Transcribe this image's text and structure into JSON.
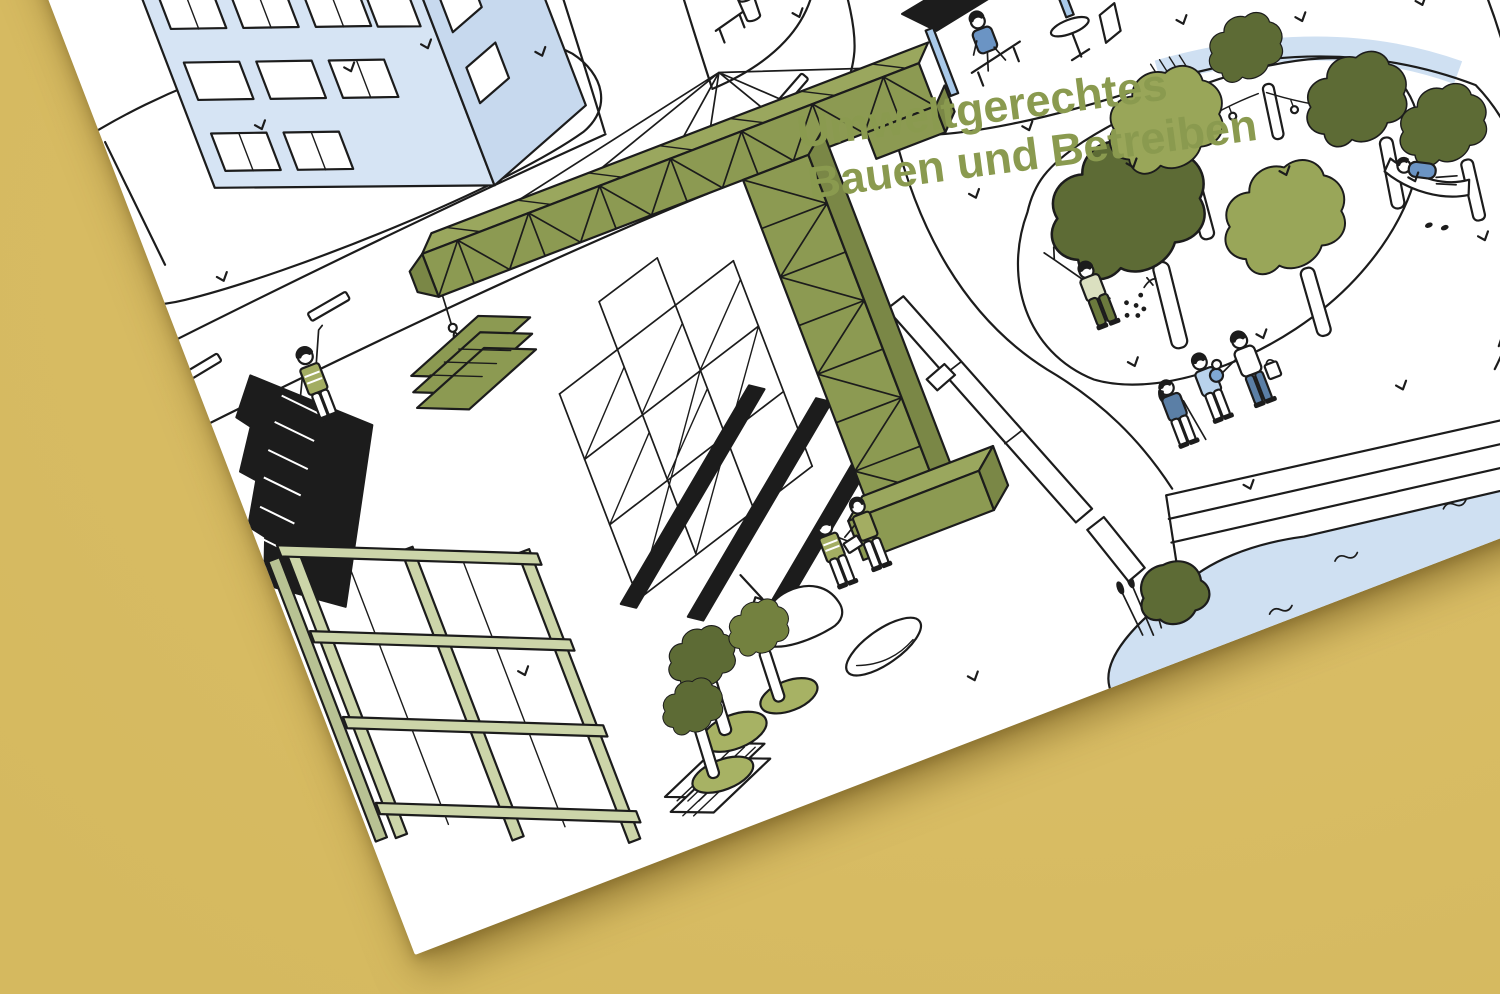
{
  "background": {
    "color": "#dcc06a",
    "label": "mustard paper backdrop"
  },
  "poster": {
    "type": "illustrated poster mockup, tilted flat-lay photo",
    "rotation_deg": -21,
    "paper_color": "#ffffff",
    "title": {
      "line1": "Umweltgerechtes",
      "line2": "Bauen und Betreiben"
    },
    "palette": {
      "bg": "#dcc06a",
      "ink": "#1c1c1c",
      "paper": "#ffffff",
      "title_green": "#8a9a4f",
      "olive": "#8c9a52",
      "olive_top": "#9aa75e",
      "olive_side": "#7a8746",
      "olive_dark": "#5d6b35",
      "olive_mid": "#73813f",
      "olive_light": "#99a659",
      "ground_green": "#a7b264",
      "sage": "#ccd5a9",
      "sage_dark": "#b8c293",
      "vest": "#a3ad62",
      "pale_shirt": "#dbe0c0",
      "pants_olive": "#6b7a3d",
      "blue_pale": "#d6e4f4",
      "blue_pale2": "#c7d9ee",
      "water": "#cfe0f2",
      "blue_light": "#b9d3ec",
      "blue_post": "#a9c9e9",
      "blue_mid": "#6b94c4",
      "blue_slate": "#5b7fa6",
      "blue_baby": "#7fa8d4"
    },
    "scene": {
      "description": "isometric line illustration of environmentally friendly construction and operation: building site with tower crane beside a neighbourhood park at the waterfront",
      "elements": [
        "apartment-building",
        "lawn-island",
        "street-lamp",
        "main-road",
        "lane-markings",
        "side-street",
        "street-bench",
        "trash-bin",
        "kiosk-with-seated-person",
        "tower-crane",
        "crane-hook-load",
        "steel-frame-scaffold",
        "solar-roof-building",
        "timber-frame-building",
        "construction-fence",
        "sand-pile-with-shovel",
        "excavation-pit",
        "lumber-stack",
        "sapling-trees",
        "worker-waving",
        "workers-talking",
        "park-lawn",
        "park-path",
        "bike-path",
        "park-trees",
        "string-lights",
        "hammock-person",
        "gardener-picking-berries",
        "family-walking",
        "waterfront-steps",
        "reeds",
        "shore-bush",
        "water",
        "bird-marks"
      ]
    }
  }
}
